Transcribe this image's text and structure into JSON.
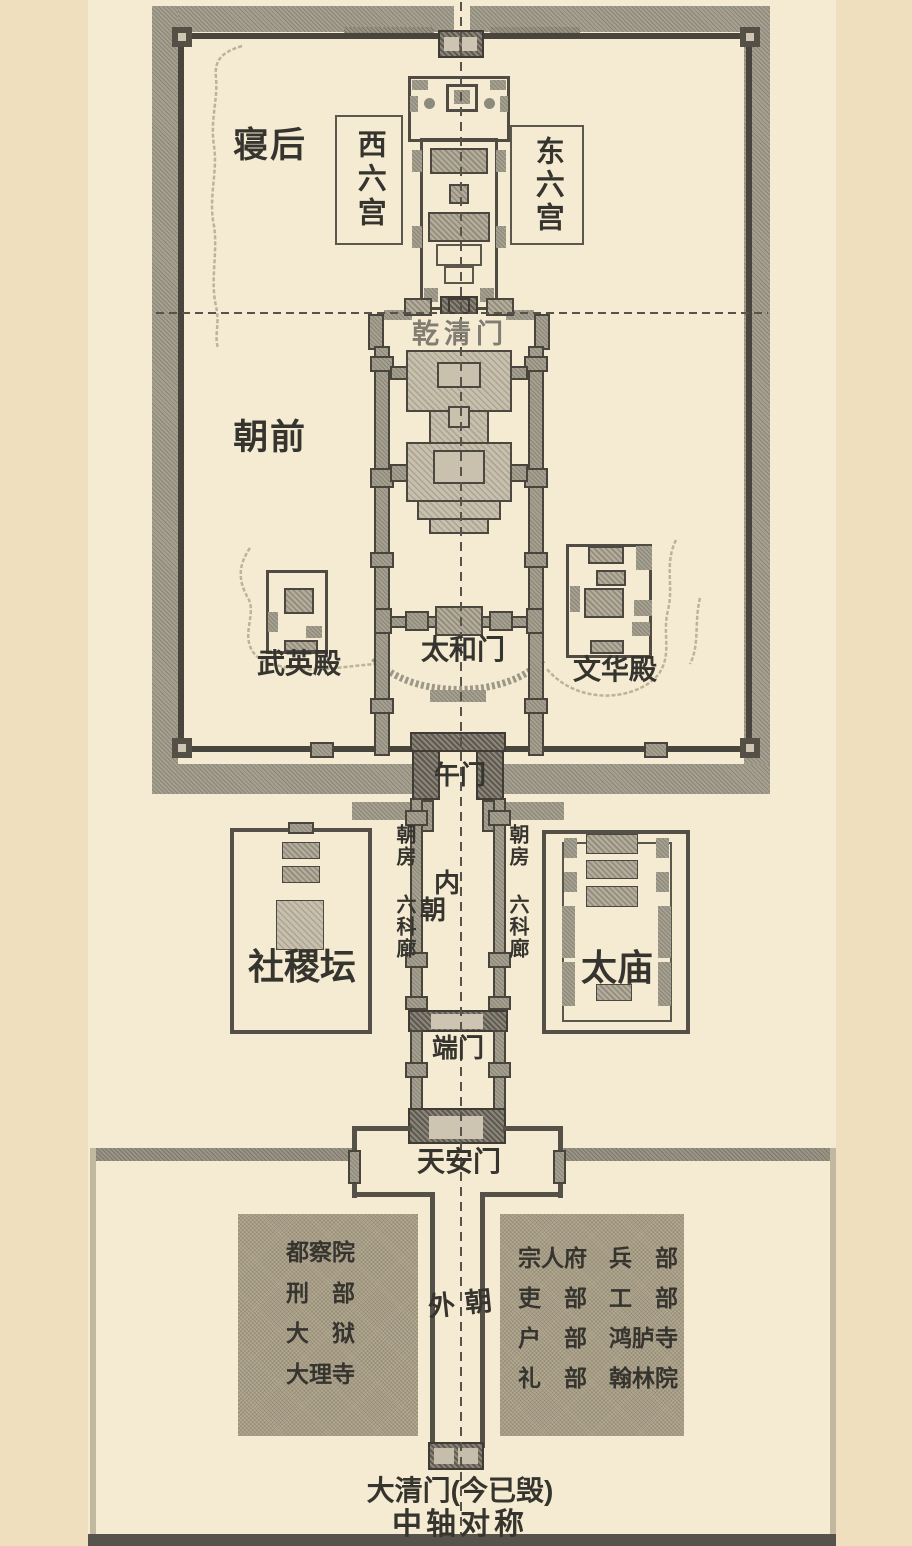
{
  "labels": {
    "hou_qin": "后寝",
    "qian_chao": "前朝",
    "nei_chao": "内朝",
    "wai_chao": "外朝"
  },
  "boxes": {
    "west": "西六宫",
    "east": "东六宫"
  },
  "gates": {
    "qianqingmen": "乾清门",
    "taihemen": "太和门",
    "wumen": "午门",
    "duanmen": "端门",
    "tiananmen": "天安门",
    "daqingmen": "大清门(今已毁)"
  },
  "halls": {
    "wuyingdian": "武英殿",
    "wenhuadian": "文华殿",
    "shejitan": "社稷坛",
    "taimiao": "太庙"
  },
  "corridor": {
    "chaofang": "朝房",
    "liukelang": "六科廊"
  },
  "offices_left": [
    "都察院",
    "刑　部",
    "大　狱",
    "大理寺"
  ],
  "offices_right": [
    {
      "c1": "宗人府",
      "c2": "兵　部"
    },
    {
      "c1": "吏　部",
      "c2": "工　部"
    },
    {
      "c1": "户　部",
      "c2": "鸿胪寺"
    },
    {
      "c1": "礼　部",
      "c2": "翰林院"
    }
  ],
  "captions": {
    "axis": "中轴对称"
  },
  "colors": {
    "paper": "#f4ebd2",
    "margin": "#f0dfbf",
    "wall_gray": "#a5a090",
    "dark_line": "#4d483f",
    "text": "#36342e",
    "bottom_bar": "#55534b"
  }
}
